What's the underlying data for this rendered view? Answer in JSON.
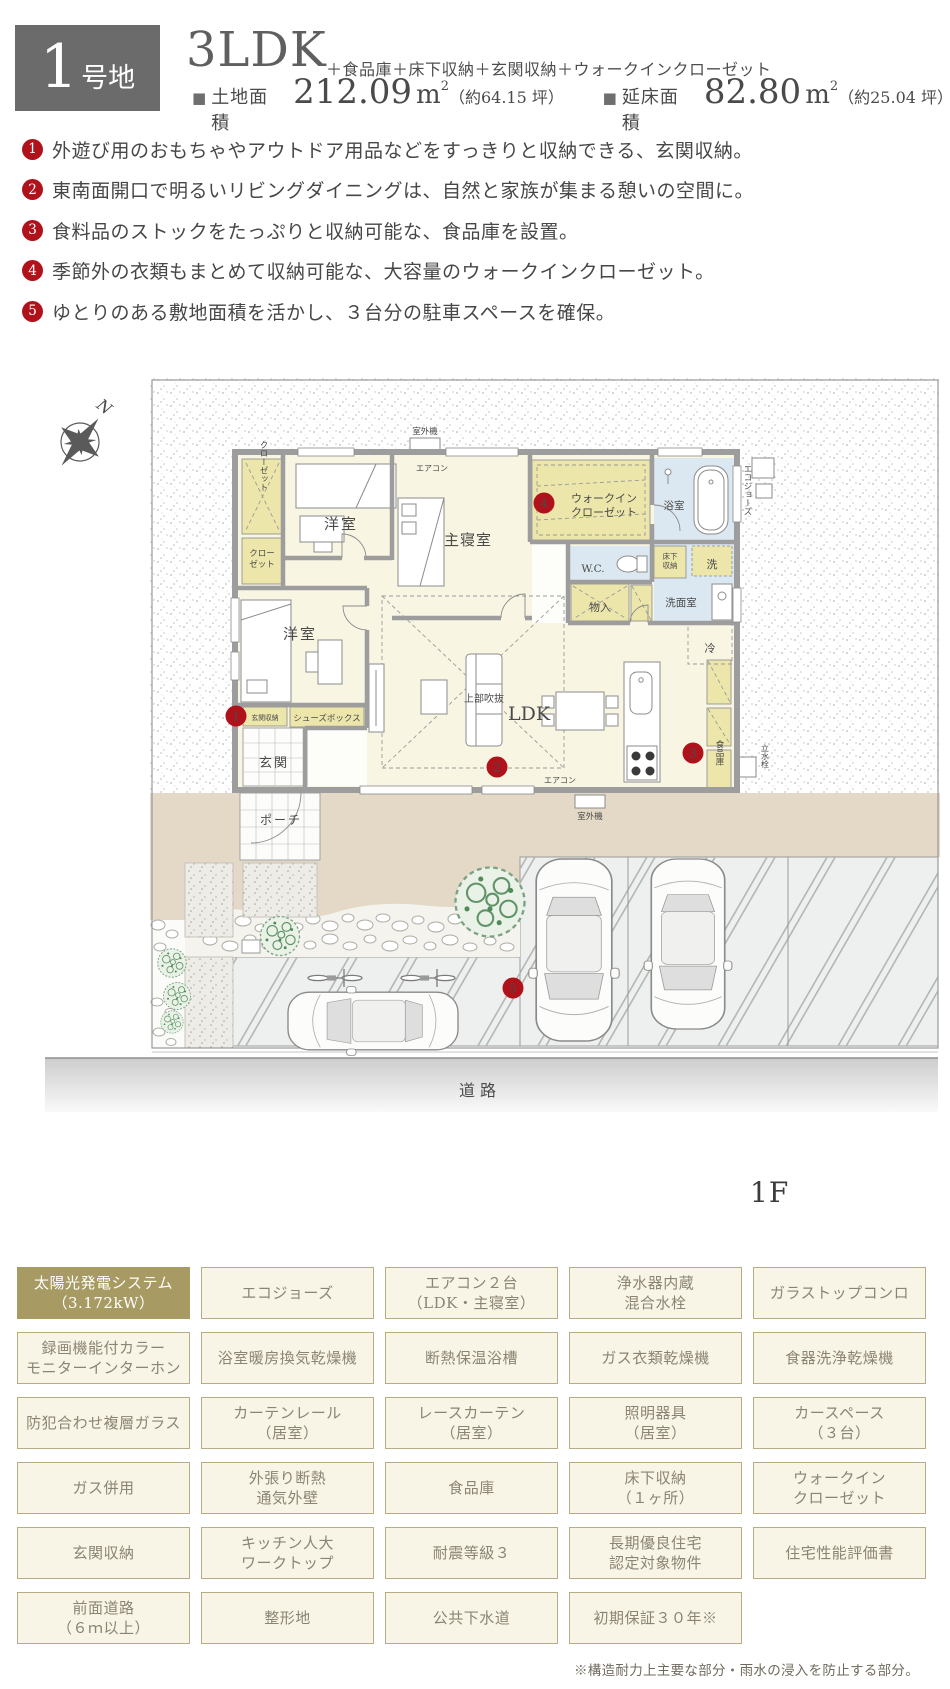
{
  "header": {
    "lot_number": "1",
    "lot_suffix": "号地",
    "plan_type": "3LDK",
    "plan_extras": "＋食品庫＋床下収納＋玄関収納＋ウォークインクローゼット",
    "land_area": {
      "icon": "■",
      "label": "土地面積",
      "value": "212.09",
      "unit": "m",
      "unit_sup": "2",
      "tsubo": "（約64.15 坪）"
    },
    "floor_area": {
      "icon": "■",
      "label": "延床面積",
      "value": "82.80",
      "unit": "m",
      "unit_sup": "2",
      "tsubo": "（約25.04 坪）"
    }
  },
  "features": [
    {
      "number": "1",
      "text": "外遊び用のおもちゃやアウトドア用品などをすっきりと収納できる、玄関収納。"
    },
    {
      "number": "2",
      "text": "東南面開口で明るいリビングダイニングは、自然と家族が集まる憩いの空間に。"
    },
    {
      "number": "3",
      "text": "食料品のストックをたっぷりと収納可能な、食品庫を設置。"
    },
    {
      "number": "4",
      "text": "季節外の衣類もまとめて収納可能な、大容量のウォークインクローゼット。"
    },
    {
      "number": "5",
      "text": "ゆとりのある敷地面積を活かし、３台分の駐車スペースを確保。"
    }
  ],
  "plan": {
    "compass_n": "N",
    "floor_label": "1F",
    "road_label": "道路",
    "rooms": {
      "western_room": "洋室",
      "master_bedroom": "主寝室",
      "ldk": "LDK",
      "void_above": "上部吹抜",
      "entrance": "玄関",
      "porch": "ポーチ",
      "bathroom": "浴室",
      "washroom": "洗面室",
      "wc": "W.C.",
      "closet_v": "クローゼット",
      "closet_l1": "クロー",
      "closet_l2": "ゼット",
      "wic_l1": "ウォークイン",
      "wic_l2": "クローゼット",
      "underfloor_l1": "床下",
      "underfloor_l2": "収納",
      "laundry": "洗",
      "storage": "物入",
      "fridge": "冷",
      "pantry": "食品庫",
      "entrance_storage": "玄関収納",
      "shoe_box": "シューズボックス",
      "aircon": "エアコン",
      "outdoor_unit": "室外機",
      "eco_jozu": "エコジョーズ",
      "water_tap": "立水栓"
    },
    "markers": [
      {
        "number": "1"
      },
      {
        "number": "2"
      },
      {
        "number": "3"
      },
      {
        "number": "4"
      },
      {
        "number": "5"
      }
    ]
  },
  "equipment": {
    "items": [
      {
        "label": "太陽光発電システム\n（3.172kW）",
        "highlight": true
      },
      {
        "label": "エコジョーズ"
      },
      {
        "label": "エアコン２台\n（LDK・主寝室）"
      },
      {
        "label": "浄水器内蔵\n混合水栓"
      },
      {
        "label": "ガラストップコンロ"
      },
      {
        "label": "録画機能付カラー\nモニターインターホン"
      },
      {
        "label": "浴室暖房換気乾燥機"
      },
      {
        "label": "断熱保温浴槽"
      },
      {
        "label": "ガス衣類乾燥機"
      },
      {
        "label": "食器洗浄乾燥機"
      },
      {
        "label": "防犯合わせ複層ガラス"
      },
      {
        "label": "カーテンレール\n（居室）"
      },
      {
        "label": "レースカーテン\n（居室）"
      },
      {
        "label": "照明器具\n（居室）"
      },
      {
        "label": "カースペース\n（３台）"
      },
      {
        "label": "ガス併用"
      },
      {
        "label": "外張り断熱\n通気外壁"
      },
      {
        "label": "食品庫"
      },
      {
        "label": "床下収納\n（１ヶ所）"
      },
      {
        "label": "ウォークイン\nクローゼット"
      },
      {
        "label": "玄関収納"
      },
      {
        "label": "キッチン人大\nワークトップ"
      },
      {
        "label": "耐震等級３"
      },
      {
        "label": "長期優良住宅\n認定対象物件"
      },
      {
        "label": "住宅性能評価書"
      },
      {
        "label": "前面道路\n（６ｍ以上）"
      },
      {
        "label": "整形地"
      },
      {
        "label": "公共下水道"
      },
      {
        "label": "初期保証３０年※"
      }
    ]
  },
  "footnote": "※構造耐力上主要な部分・雨水の浸入を防止する部分。",
  "colors": {
    "accent_red": "#b0121b",
    "badge_gray": "#6b6b6b",
    "highlight_olive": "#a79a63",
    "box_bg": "#f8f5e6",
    "box_border": "#b7ac83",
    "house_floor": "#f8f5e3",
    "storage_yellow": "#ece6ab",
    "wet_blue": "#dce8f1",
    "ground_tan": "#e3d9c6"
  }
}
